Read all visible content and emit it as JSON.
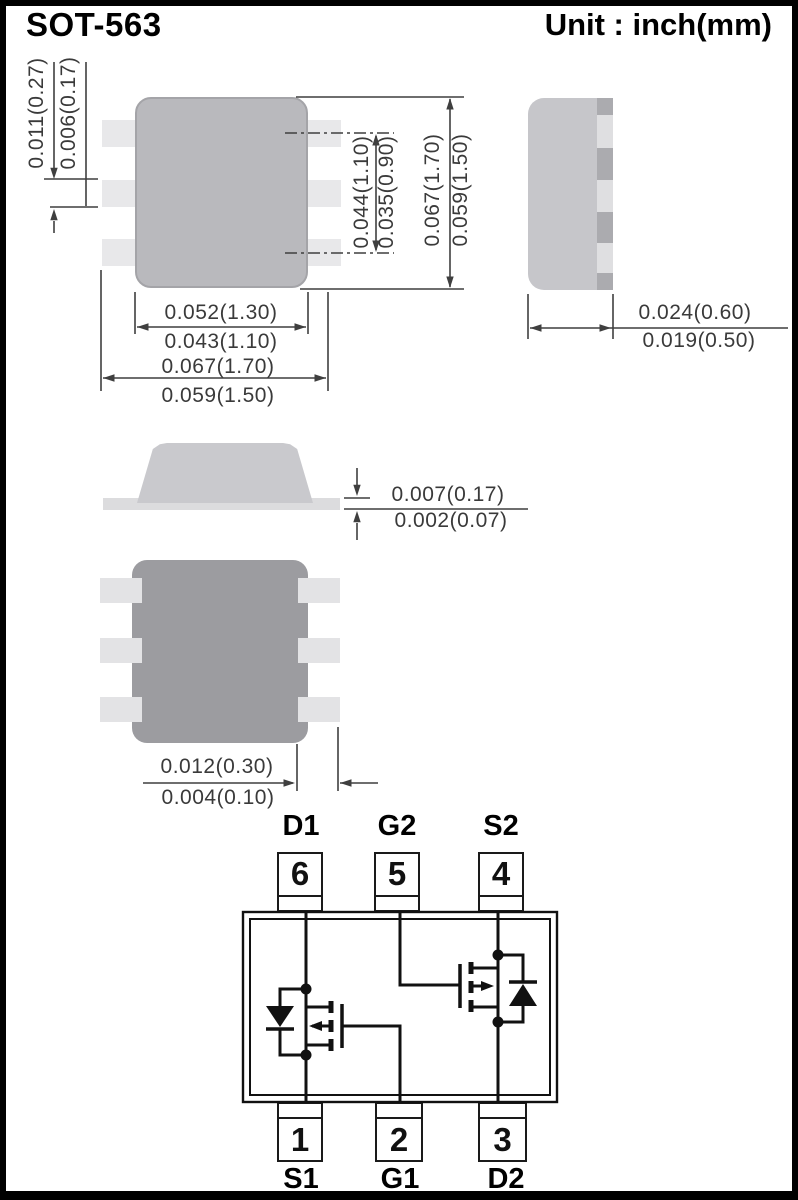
{
  "header": {
    "title": "SOT-563",
    "unit_label": "Unit : inch(mm)"
  },
  "dimensions": {
    "lead_width": {
      "max": "0.011(0.27)",
      "min": "0.006(0.17)"
    },
    "pin_span_inner": {
      "max": "0.044(1.10)",
      "min": "0.035(0.90)"
    },
    "body_height": {
      "max": "0.067(1.70)",
      "min": "0.059(1.50)"
    },
    "body_width": {
      "max": "0.052(1.30)",
      "min": "0.043(1.10)"
    },
    "overall_width": {
      "max": "0.067(1.70)",
      "min": "0.059(1.50)"
    },
    "side_thickness": {
      "max": "0.024(0.60)",
      "min": "0.019(0.50)"
    },
    "standoff": {
      "max": "0.007(0.17)",
      "min": "0.002(0.07)"
    },
    "pad_length": {
      "max": "0.012(0.30)",
      "min": "0.004(0.10)"
    }
  },
  "pinout": {
    "top": [
      {
        "number": "6",
        "label": "D1"
      },
      {
        "number": "5",
        "label": "G2"
      },
      {
        "number": "4",
        "label": "S2"
      }
    ],
    "bottom": [
      {
        "number": "1",
        "label": "S1"
      },
      {
        "number": "2",
        "label": "G1"
      },
      {
        "number": "3",
        "label": "D2"
      }
    ]
  },
  "colors": {
    "top_body_gray": "#b9b9bd",
    "pad_gray": "#e8e8ea",
    "bottom_body_gray": "#9c9ca0",
    "side_body_gray": "#c6c6ca",
    "dimension_line": "#3f3f3f",
    "schematic_line": "#111111"
  }
}
